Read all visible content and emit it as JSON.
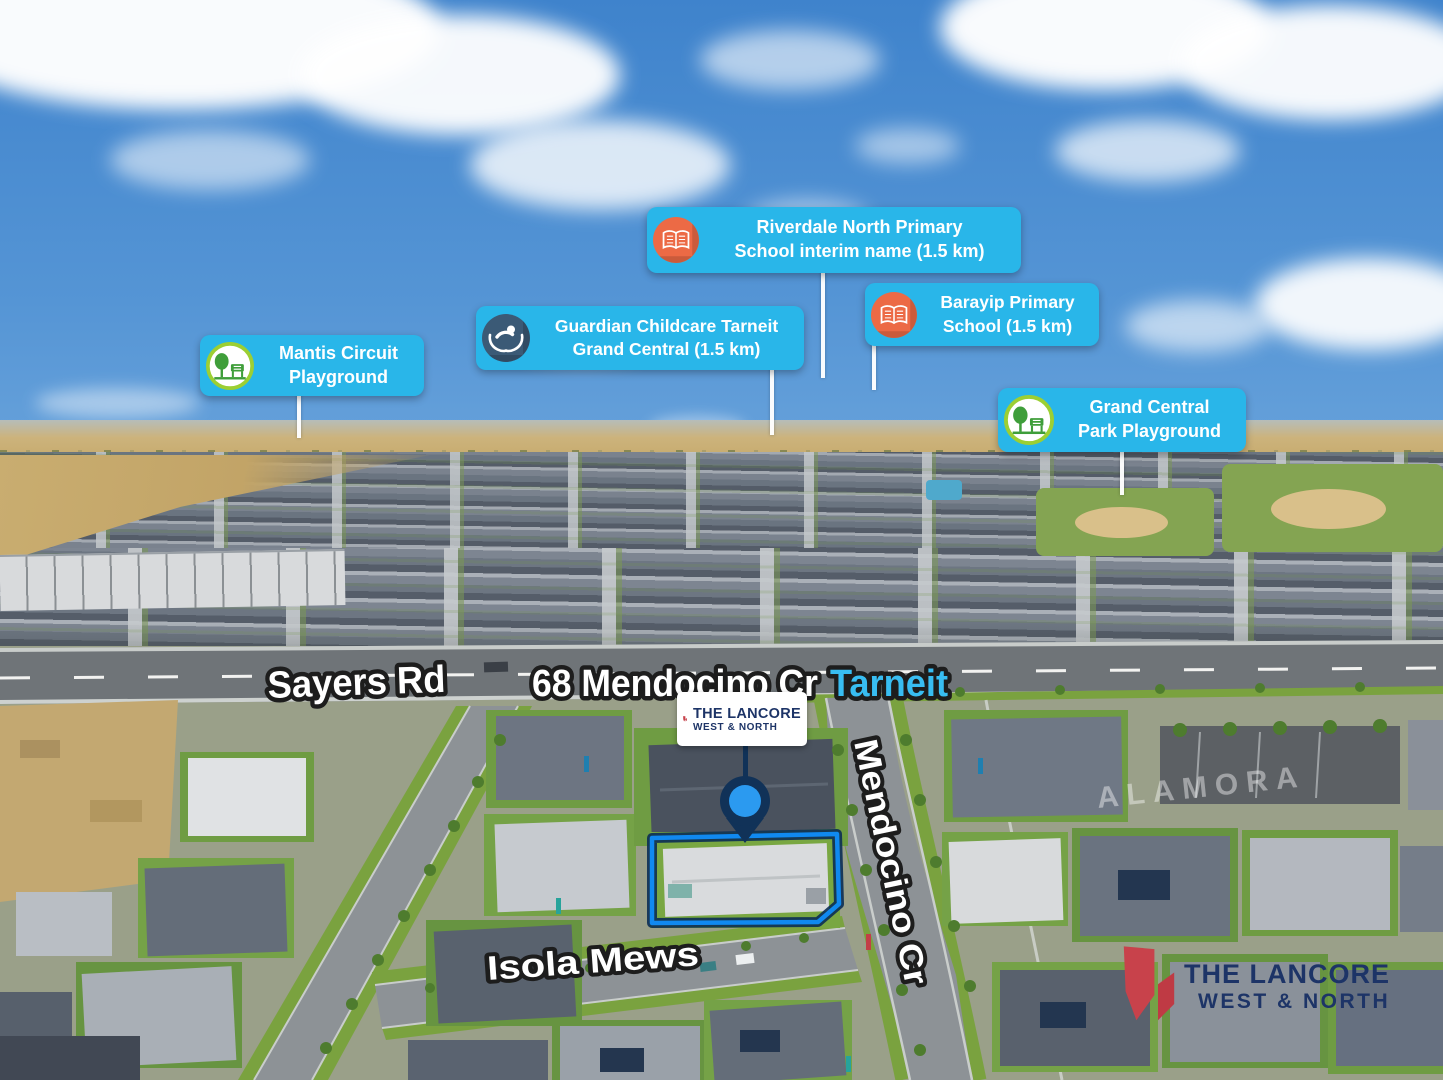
{
  "property": {
    "address": "68 Mendocino Cr",
    "suburb": "Tarneit"
  },
  "streets": {
    "sayers": "Sayers Rd",
    "isola": "Isola Mews",
    "mendocino": "Mendocino Cr"
  },
  "ground_text": "ALAMORA",
  "callouts": {
    "riverdale": {
      "icon": "book-icon",
      "line1": "Riverdale North Primary",
      "line2": "School interim name (1.5 km)"
    },
    "barayip": {
      "icon": "book-icon",
      "line1": "Barayip Primary",
      "line2": "School (1.5 km)"
    },
    "guardian": {
      "icon": "childcare-icon",
      "line1": "Guardian Childcare Tarneit",
      "line2": "Grand Central (1.5 km)"
    },
    "mantis": {
      "icon": "playground-icon",
      "line1": "Mantis Circuit",
      "line2": "Playground"
    },
    "grand": {
      "icon": "playground-icon",
      "line1": "Grand Central",
      "line2": "Park Playground"
    }
  },
  "brand": {
    "name": "THE LANCORE",
    "tagline": "WEST & NORTH"
  },
  "colors": {
    "badge_blue": "#29b6e9",
    "icon_orange": "#ec6a45",
    "icon_navy": "#3b5a76",
    "ring_lime": "#9ccf33",
    "icon_green": "#3f9e3a",
    "suburb_cyan": "#38bdf2",
    "pin_navy": "#113258",
    "pin_blue": "#2b9af0",
    "outline_blue": "#1089f0",
    "brand_navy": "#1d3467",
    "brand_red": "#c8424b"
  }
}
